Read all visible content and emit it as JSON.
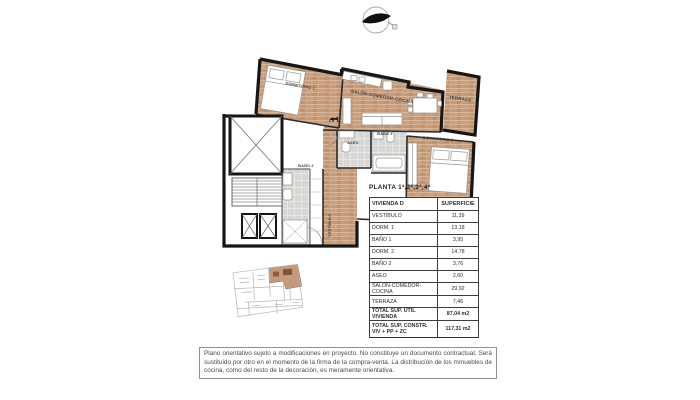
{
  "floor_plan": {
    "rooms": {
      "dormitorio1": "DORMITORIO 1",
      "salon": "SALÓN-COMEDOR-COCINA",
      "terraza": "TERRAZA",
      "dormitorio2": "DORMITORIO 2",
      "bano1": "BAÑO 1",
      "aseo": "ASEO",
      "bano2": "BAÑO 2",
      "vestibulo": "VESTÍBULO"
    },
    "colors": {
      "brick_floor": "#c59a7a",
      "wall": "#161616",
      "tile_floor": "#d7d7d5",
      "keyplan_highlight": "#c49a7a"
    }
  },
  "table": {
    "title": "PLANTA 1ª,2ª,3ª,4ª",
    "headers": [
      "VIVIENDA D",
      "SUPERFICIE"
    ],
    "rows": [
      {
        "label": "VESTÍBULO",
        "value": "11,39"
      },
      {
        "label": "DORM. 1",
        "value": "13,18"
      },
      {
        "label": "BAÑO 1",
        "value": "3,95"
      },
      {
        "label": "DORM. 2",
        "value": "14,78"
      },
      {
        "label": "BAÑO 2",
        "value": "3,76"
      },
      {
        "label": "ASEO",
        "value": "2,60"
      },
      {
        "label": "SALÓN-COMEDOR-COCINA",
        "value": "29,92"
      },
      {
        "label": "TERRAZA",
        "value": "7,46"
      }
    ],
    "totals": [
      {
        "label": "TOTAL SUP. ÚTIL VIVIENDA",
        "value": "87,04 m2"
      },
      {
        "label": "TOTAL SUP. CONSTR.",
        "label2": "VIV + PP + ZC",
        "value": "117,31 m2"
      }
    ]
  },
  "disclaimer": "Plano orientativo sujeto a modificaciones en proyecto. No constituye un documento contractual. Será sustituido por otro en el momento de la firma de la compra-venta. La distribución de los mmuebles de cocina, como del resto de la decoración, es meramente orientativa."
}
